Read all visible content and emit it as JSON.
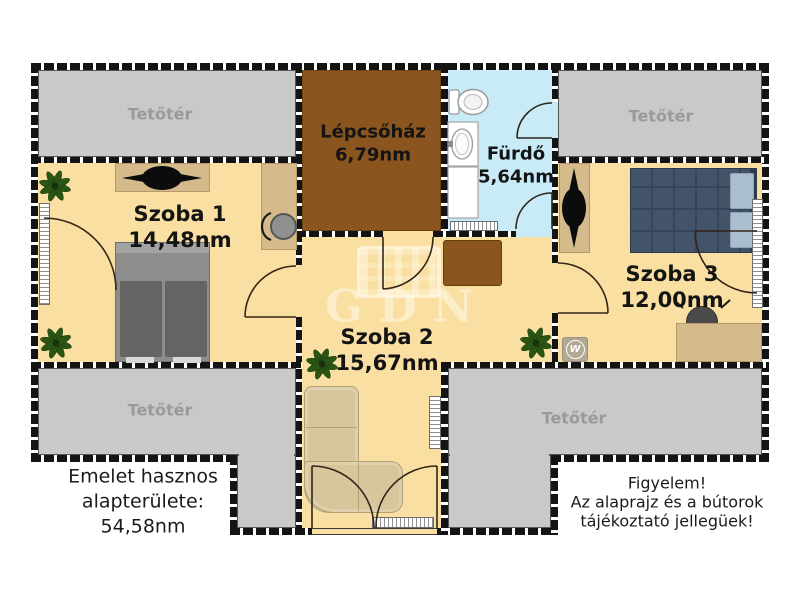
{
  "plan": {
    "watermark": "GDN",
    "attic_label": "Tetőtér",
    "rooms": {
      "szoba1": {
        "name": "Szoba 1",
        "area": "14,48nm"
      },
      "szoba2": {
        "name": "Szoba 2",
        "area": "15,67nm"
      },
      "szoba3": {
        "name": "Szoba 3",
        "area": "12,00nm"
      },
      "furdo": {
        "name": "Fürdő",
        "area": "5,64nm"
      },
      "lepcsohaz": {
        "name": "Lépcsőház",
        "area": "6,79nm"
      }
    },
    "notes": {
      "area_note": {
        "line1": "Emelet hasznos",
        "line2": "alapterülete:",
        "line3": "54,58nm"
      },
      "disclaimer": {
        "line1": "Figyelem!",
        "line2": "Az alaprajz és a bútorok",
        "line3": "tájékoztató jellegüek!"
      }
    },
    "badge_letter": "W",
    "colors": {
      "floor": "#FADFA2",
      "attic": "#C9C9C9",
      "attic_text": "#9A9A9A",
      "stairs": "#8A551F",
      "bath": "#C9EBF8",
      "wall": "#141414",
      "furniture_tan": "#D5BB8C",
      "couch": "#D7C69C",
      "bed_gray": "#8D8D8D",
      "bed_navy": "#42536A"
    }
  }
}
